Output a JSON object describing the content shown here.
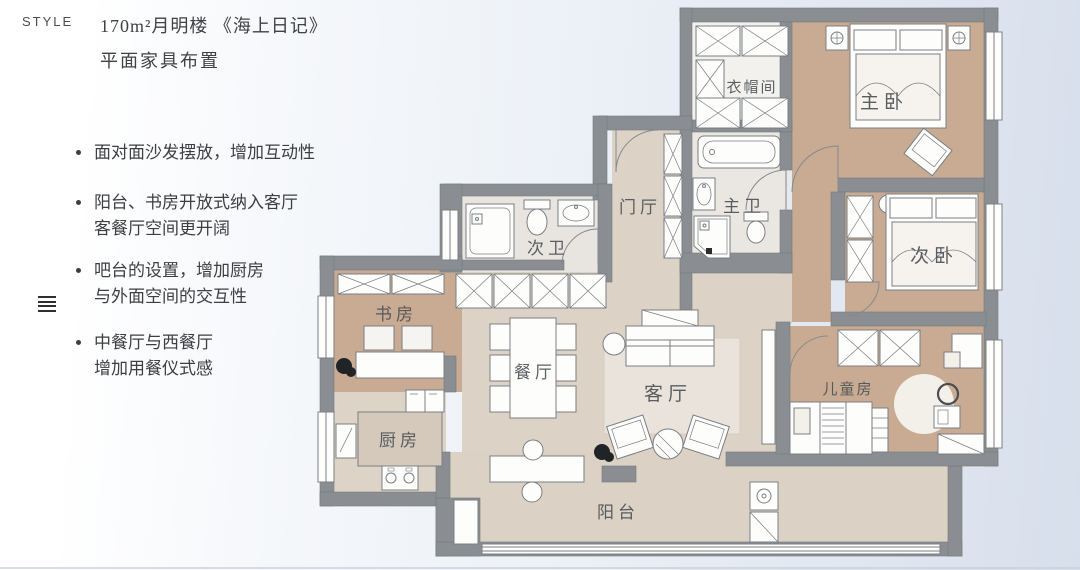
{
  "page": {
    "style_label": "STYLE",
    "title_line1": "170m²月明楼 《海上日记》",
    "title_line2": "平面家具布置",
    "bullets": [
      {
        "line1": "面对面沙发摆放，增加互动性",
        "line2": ""
      },
      {
        "line1": "阳台、书房开放式纳入客厅",
        "line2": "客餐厅空间更开阔"
      },
      {
        "line1": "吧台的设置，增加厨房",
        "line2": "与外面空间的交互性"
      },
      {
        "line1": "中餐厅与西餐厅",
        "line2": "增加用餐仪式感"
      }
    ]
  },
  "floorplan": {
    "rooms": [
      {
        "id": "cloakroom",
        "label": "衣帽间"
      },
      {
        "id": "master-bedroom",
        "label": "主卧"
      },
      {
        "id": "entry-hall",
        "label": "门厅"
      },
      {
        "id": "master-bath",
        "label": "主卫"
      },
      {
        "id": "second-bath",
        "label": "次卫"
      },
      {
        "id": "second-bedroom",
        "label": "次卧"
      },
      {
        "id": "study",
        "label": "书房"
      },
      {
        "id": "dining",
        "label": "餐厅"
      },
      {
        "id": "living",
        "label": "客厅"
      },
      {
        "id": "kids-room",
        "label": "儿童房"
      },
      {
        "id": "kitchen",
        "label": "厨房"
      },
      {
        "id": "balcony",
        "label": "阳台"
      }
    ],
    "colors": {
      "wall": "#8a8e92",
      "wood_floor": "#c8ab92",
      "beige_floor": "#dcd2c6",
      "bath_floor": "#eae7e2",
      "background_tint": "#dde4ef",
      "text": "#3c3e41"
    }
  }
}
